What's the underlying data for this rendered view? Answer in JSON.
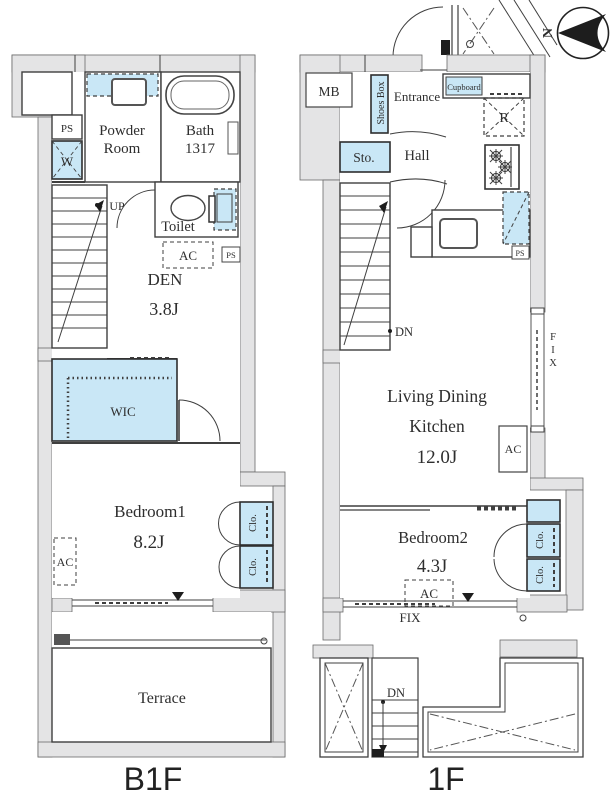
{
  "colors": {
    "wall": "#e4e4e5",
    "fixture": "#c9e7f6",
    "line": "#3f3f3f"
  },
  "compass": {
    "north_label": "N"
  },
  "b1f": {
    "floor_label": "B1F",
    "labels": {
      "ps_top": "PS",
      "washer": "W",
      "powder_1": "Powder",
      "powder_2": "Room",
      "bath_1": "Bath",
      "bath_2": "1317",
      "up": "UP",
      "toilet": "Toilet",
      "ac_den": "AC",
      "ps_mid": "PS",
      "den_name": "DEN",
      "den_size": "3.8J",
      "wic": "WIC",
      "bedroom_name": "Bedroom1",
      "bedroom_size": "8.2J",
      "ac_bedroom": "AC",
      "clo_upper": "Clo.",
      "clo_lower": "Clo.",
      "fix": "FIX",
      "terrace": "Terrace"
    }
  },
  "f1": {
    "floor_label": "1F",
    "labels": {
      "mb": "MB",
      "shoes_box": "Shoes Box",
      "entrance": "Entrance",
      "cupboard": "Cupboard",
      "fridge": "R",
      "sto": "Sto.",
      "hall": "Hall",
      "dn_stairs": "DN",
      "ldk_1": "Living Dining",
      "ldk_2": "Kitchen",
      "ldk_3": "12.0J",
      "fix_right": "FIX",
      "ac_wall": "AC",
      "ps_kitchen": "PS",
      "bedroom_name": "Bedroom2",
      "bedroom_size": "4.3J",
      "ac_bedroom": "AC",
      "clo_upper": "Clo.",
      "clo_lower": "Clo.",
      "fix_bottom": "FIX",
      "dn_outdoor": "DN"
    }
  }
}
